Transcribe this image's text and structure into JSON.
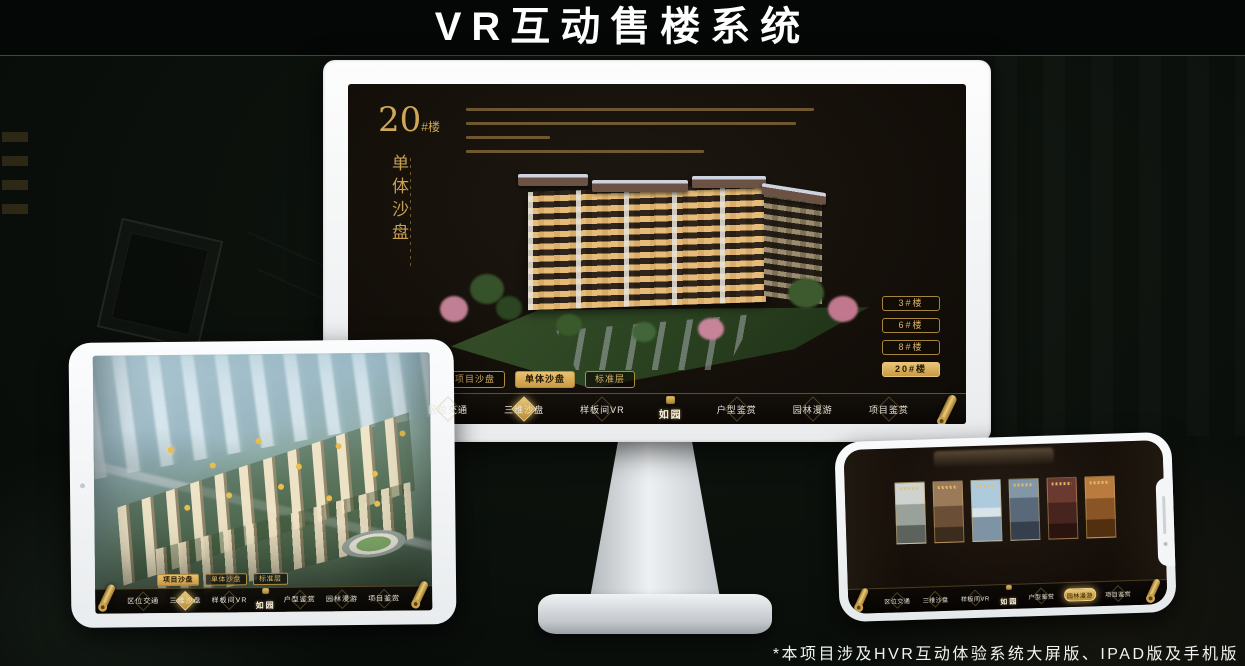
{
  "page": {
    "title": "VR互动售楼系统",
    "footnote": "*本项目涉及HVR互动体验系统大屏版、IPAD版及手机版"
  },
  "colors": {
    "gold": "#c9a052",
    "gold_bright": "#e9c572",
    "screen_bg": "#15100a",
    "nav_bg": "#0a0705"
  },
  "icons": {
    "scroll": "rolled-scroll",
    "seal": "brand-seal",
    "camera": "camera-dot",
    "nav_marker": "diamond"
  },
  "monitor": {
    "panel": {
      "number": "20",
      "suffix": "#楼",
      "subtitle": "单体沙盘"
    },
    "building_buttons": [
      {
        "label": "3#楼",
        "active": false
      },
      {
        "label": "6#楼",
        "active": false
      },
      {
        "label": "8#楼",
        "active": false
      },
      {
        "label": "20#楼",
        "active": true
      }
    ],
    "tabs": [
      {
        "label": "项目沙盘",
        "active": false
      },
      {
        "label": "单体沙盘",
        "active": true
      },
      {
        "label": "标准层",
        "active": false
      }
    ],
    "nav": {
      "logo": "如园",
      "items": [
        {
          "label": "区位交通",
          "active": false
        },
        {
          "label": "三维沙盘",
          "active": true
        },
        {
          "label": "样板间VR",
          "active": false
        },
        {
          "label": "户型鉴赏",
          "active": false
        },
        {
          "label": "园林漫游",
          "active": false
        },
        {
          "label": "项目鉴赏",
          "active": false
        }
      ]
    }
  },
  "tablet": {
    "tabs": [
      {
        "label": "项目沙盘",
        "active": true
      },
      {
        "label": "单体沙盘",
        "active": false
      },
      {
        "label": "标准层",
        "active": false
      }
    ],
    "nav": {
      "logo": "如园",
      "items": [
        {
          "label": "区位交通",
          "active": false
        },
        {
          "label": "三维沙盘",
          "active": true
        },
        {
          "label": "样板间VR",
          "active": false
        },
        {
          "label": "户型鉴赏",
          "active": false
        },
        {
          "label": "园林漫游",
          "active": false
        },
        {
          "label": "项目鉴赏",
          "active": false
        }
      ]
    }
  },
  "phone": {
    "nav": {
      "logo": "如园",
      "items": [
        {
          "label": "区位交通",
          "active": false
        },
        {
          "label": "三维沙盘",
          "active": false
        },
        {
          "label": "样板间VR",
          "active": false
        },
        {
          "label": "户型鉴赏",
          "active": false
        },
        {
          "label": "园林漫游",
          "active": true
        },
        {
          "label": "项目鉴赏",
          "active": false
        }
      ]
    }
  }
}
